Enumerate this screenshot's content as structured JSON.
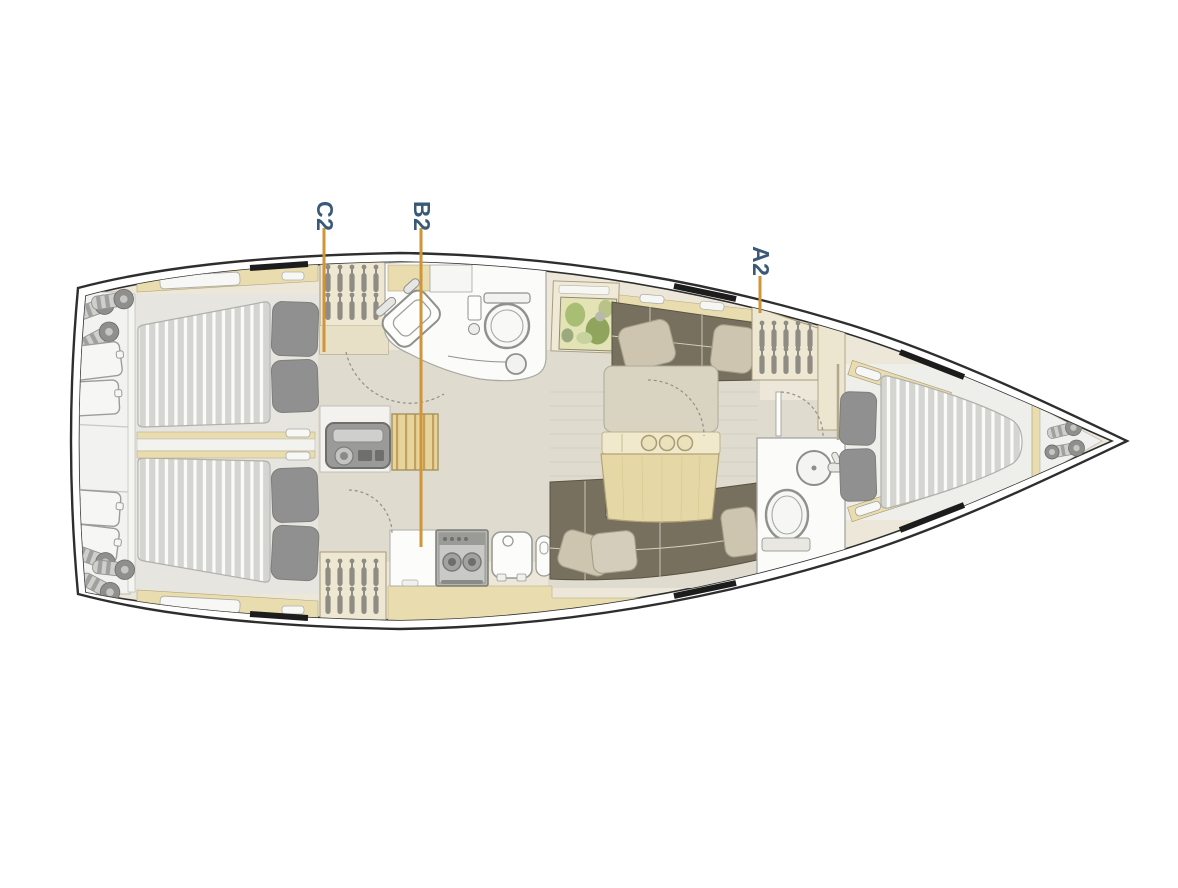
{
  "diagram": {
    "labels": [
      {
        "id": "C2",
        "text": "C2"
      },
      {
        "id": "B2",
        "text": "B2"
      },
      {
        "id": "A2",
        "text": "A2"
      }
    ],
    "colors": {
      "background": "#ffffff",
      "label_text": "#3a5878",
      "leader_line": "#cf9538",
      "hull_outline": "#2e2e2e",
      "hull_window": "#1c1c1c",
      "cabinetry_wood": "#e9ddb0",
      "floor": "#dfdbce",
      "upholstery": "#77705f",
      "settee_pillow": "#cdc5b0",
      "mattress": "#d4d4d1",
      "mattress_stripe": "#fafaf9",
      "berth_pillow": "#909090",
      "fixture_white": "#fbfbf9"
    }
  }
}
